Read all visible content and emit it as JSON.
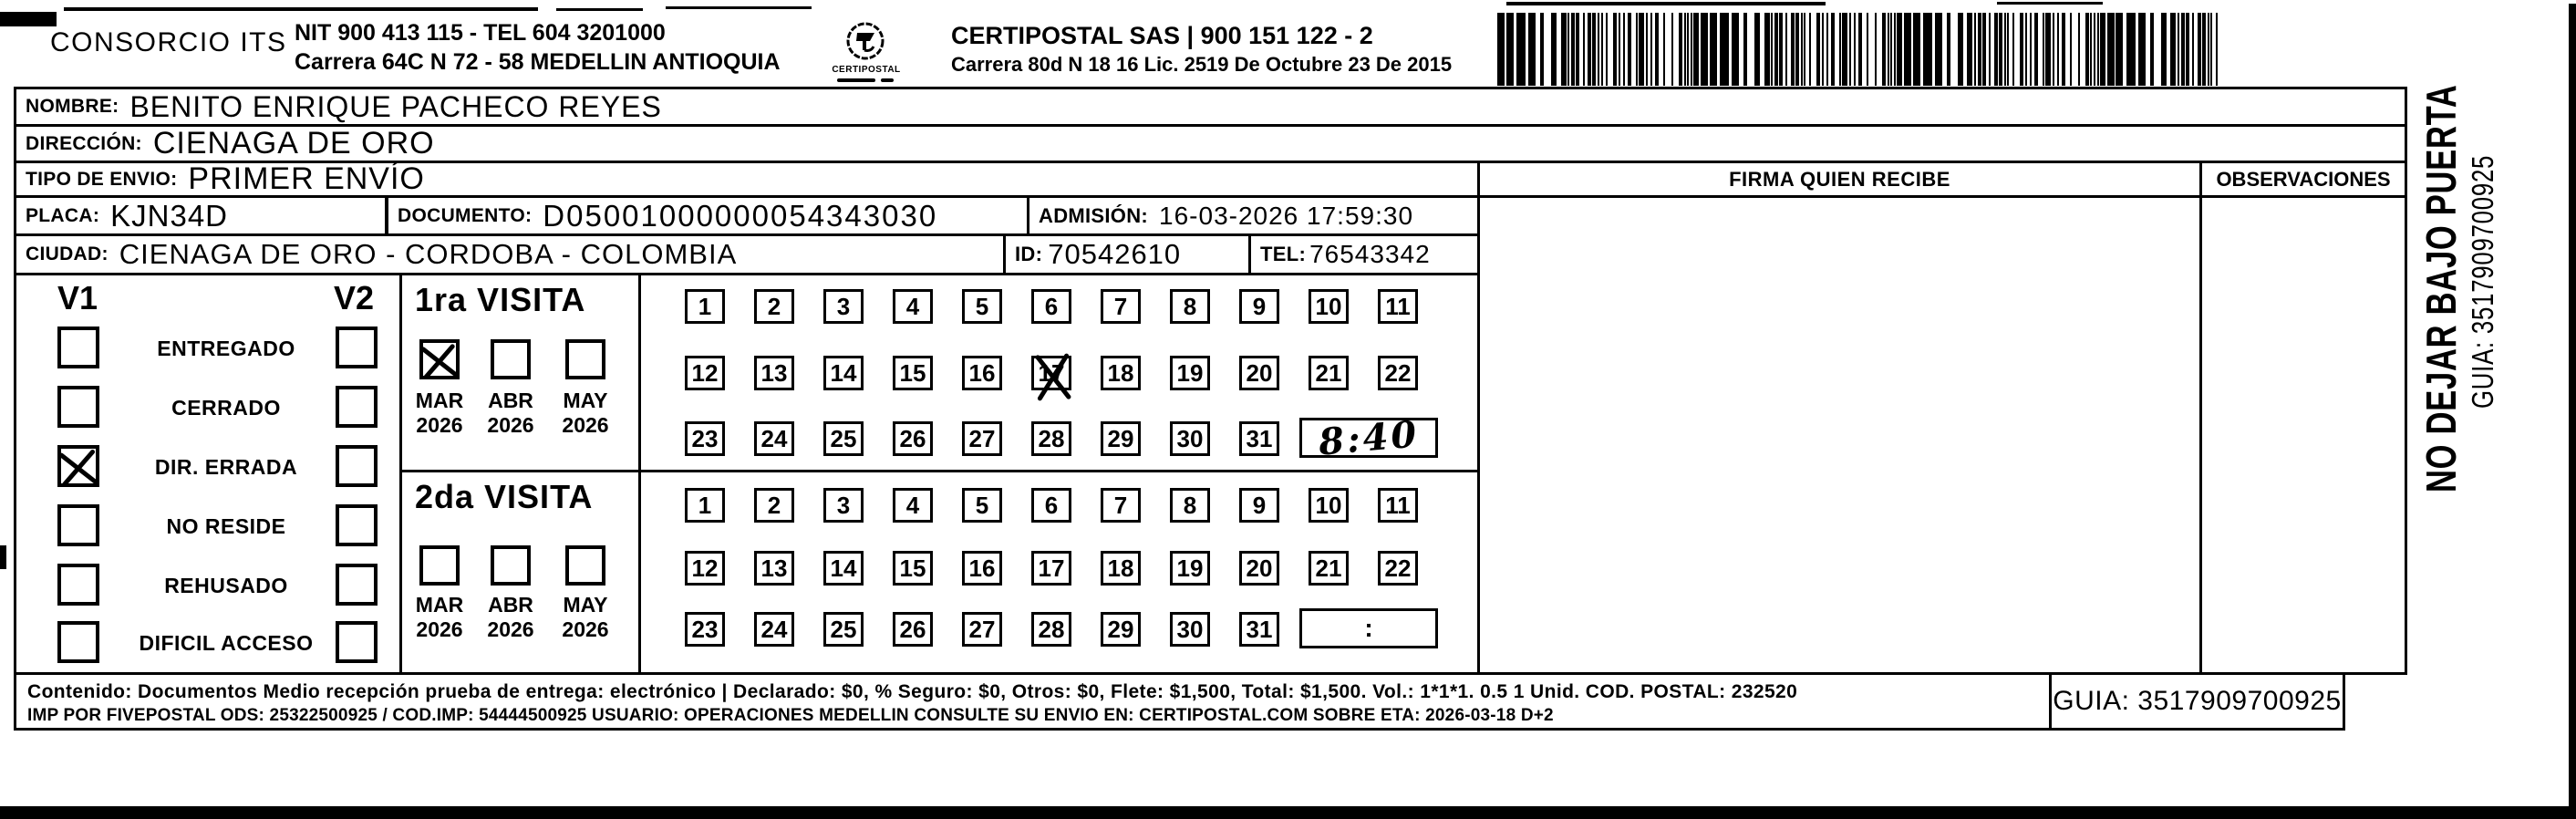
{
  "colors": {
    "ink": "#000000",
    "paper": "#ffffff"
  },
  "header": {
    "company": "CONSORCIO ITS",
    "nit_line": "NIT 900 413 115 - TEL 604 3201000",
    "address_line": "Carrera 64C N 72 - 58 MEDELLIN ANTIOQUIA",
    "logo_text": "CERTIPOSTAL",
    "brand_line": "CERTIPOSTAL SAS | 900 151 122 - 2",
    "brand_address": "Carrera 80d N 18 16  Lic. 2519 De Octubre 23 De 2015"
  },
  "shipment": {
    "nombre_label": "NOMBRE:",
    "nombre": "BENITO ENRIQUE PACHECO REYES",
    "direccion_label": "DIRECCIÓN:",
    "direccion": "CIENAGA DE ORO",
    "tipo_label": "TIPO DE ENVIO:",
    "tipo": "PRIMER ENVÍO",
    "placa_label": "PLACA:",
    "placa": "KJN34D",
    "documento_label": "DOCUMENTO:",
    "documento": "D05001000000054343030",
    "admision_label": "ADMISIÓN:",
    "admision": "16-03-2026 17:59:30",
    "ciudad_label": "CIUDAD:",
    "ciudad": "CIENAGA DE ORO - CORDOBA - COLOMBIA",
    "id_label": "ID:",
    "id_value": "70542610",
    "tel_label": "TEL:",
    "tel_value": "76543342"
  },
  "signature": {
    "firma_header": "FIRMA QUIEN RECIBE",
    "observaciones_header": "OBSERVACIONES"
  },
  "status": {
    "v1_header": "V1",
    "v2_header": "V2",
    "items": [
      {
        "label": "ENTREGADO",
        "v1": false,
        "v2": false
      },
      {
        "label": "CERRADO",
        "v1": false,
        "v2": false
      },
      {
        "label": "DIR. ERRADA",
        "v1": true,
        "v2": false
      },
      {
        "label": "NO RESIDE",
        "v1": false,
        "v2": false
      },
      {
        "label": "REHUSADO",
        "v1": false,
        "v2": false
      },
      {
        "label": "DIFICIL ACCESO",
        "v1": false,
        "v2": false
      }
    ]
  },
  "visits": [
    {
      "title": "1ra VISITA",
      "months": [
        {
          "month": "MAR",
          "year": "2026",
          "checked": true
        },
        {
          "month": "ABR",
          "year": "2026",
          "checked": false
        },
        {
          "month": "MAY",
          "year": "2026",
          "checked": false
        }
      ],
      "day_rows": [
        [
          1,
          2,
          3,
          4,
          5,
          6,
          7,
          8,
          9,
          10,
          11
        ],
        [
          12,
          13,
          14,
          15,
          16,
          17,
          18,
          19,
          20,
          21,
          22
        ],
        [
          23,
          24,
          25,
          26,
          27,
          28,
          29,
          30,
          31
        ]
      ],
      "crossed_days": [
        17
      ],
      "time_box": "8:40",
      "time_handwritten": true
    },
    {
      "title": "2da VISITA",
      "months": [
        {
          "month": "MAR",
          "year": "2026",
          "checked": false
        },
        {
          "month": "ABR",
          "year": "2026",
          "checked": false
        },
        {
          "month": "MAY",
          "year": "2026",
          "checked": false
        }
      ],
      "day_rows": [
        [
          1,
          2,
          3,
          4,
          5,
          6,
          7,
          8,
          9,
          10,
          11
        ],
        [
          12,
          13,
          14,
          15,
          16,
          17,
          18,
          19,
          20,
          21,
          22
        ],
        [
          23,
          24,
          25,
          26,
          27,
          28,
          29,
          30,
          31
        ]
      ],
      "crossed_days": [],
      "time_box": ":",
      "time_handwritten": false
    }
  ],
  "footer": {
    "line1": "Contenido: Documentos Medio recepción prueba de entrega: electrónico | Declarado: $0, % Seguro: $0, Otros: $0, Flete: $1,500, Total: $1,500. Vol.: 1*1*1. 0.5  1 Unid. COD. POSTAL: 232520",
    "line2": "IMP POR FIVEPOSTAL ODS: 25322500925 / COD.IMP: 54444500925 USUARIO: OPERACIONES MEDELLIN CONSULTE SU ENVIO EN: CERTIPOSTAL.COM SOBRE ETA: 2026-03-18 D+2",
    "guia": "GUIA: 3517909700925"
  },
  "side": {
    "warning": "NO DEJAR BAJO PUERTA",
    "guia": "GUIA: 3517909700925"
  }
}
